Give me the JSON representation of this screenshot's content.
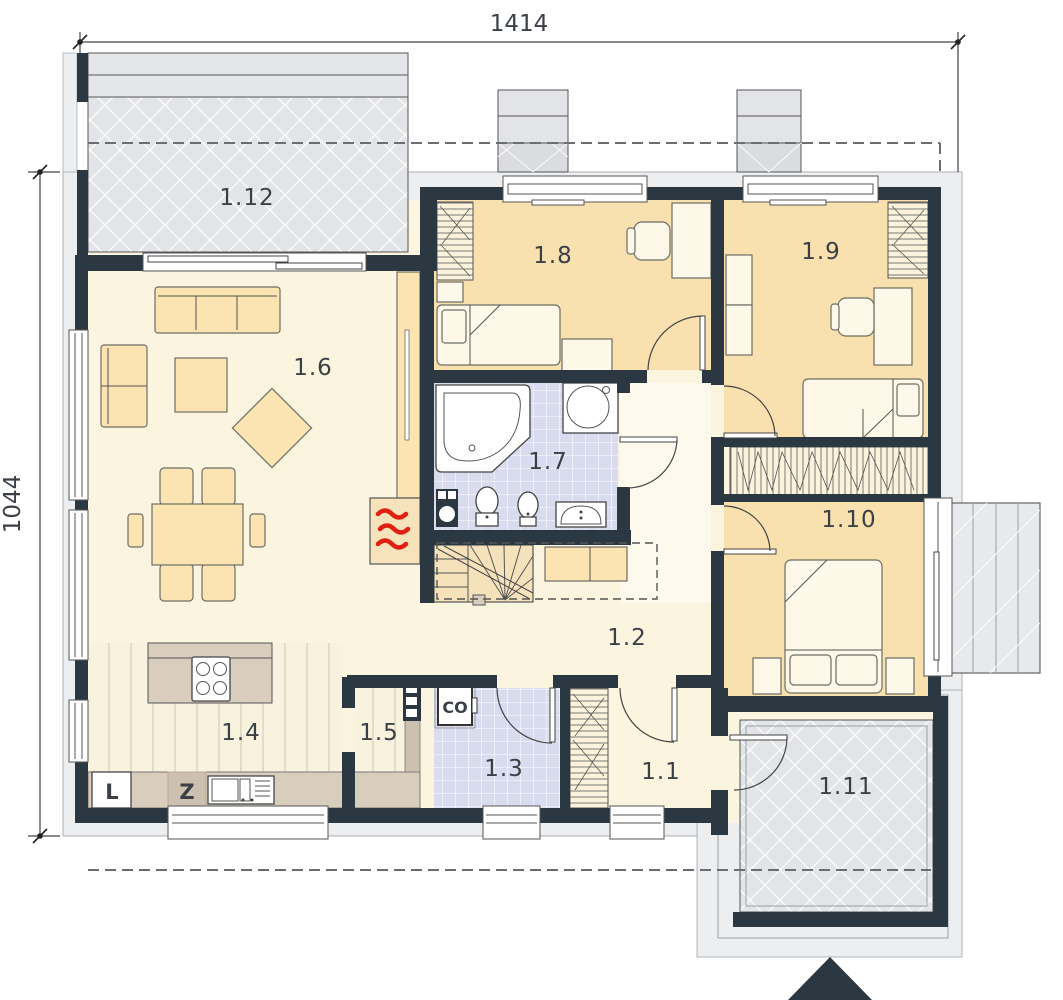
{
  "plan_title": "ground-floor-plan",
  "dimensions": {
    "width_cm": "1414",
    "height_cm": "1044"
  },
  "rooms": [
    {
      "number": "1.1"
    },
    {
      "number": "1.2"
    },
    {
      "number": "1.3"
    },
    {
      "number": "1.4"
    },
    {
      "number": "1.5"
    },
    {
      "number": "1.6"
    },
    {
      "number": "1.7"
    },
    {
      "number": "1.8"
    },
    {
      "number": "1.9"
    },
    {
      "number": "1.10"
    },
    {
      "number": "1.11"
    },
    {
      "number": "1.12"
    }
  ],
  "markers": {
    "fridge_label": "L",
    "dishwasher_label": "Z",
    "heating_label": "CO"
  },
  "colors": {
    "wall": "#2B3842",
    "living_floor": "#FBF4DF",
    "bedroom_floor": "#F8E1AE",
    "bath_floor": "#D9DBEE",
    "terrace": "#E2E4E7",
    "counter": "#D9CDBD",
    "flame_accent": "#E02010"
  }
}
